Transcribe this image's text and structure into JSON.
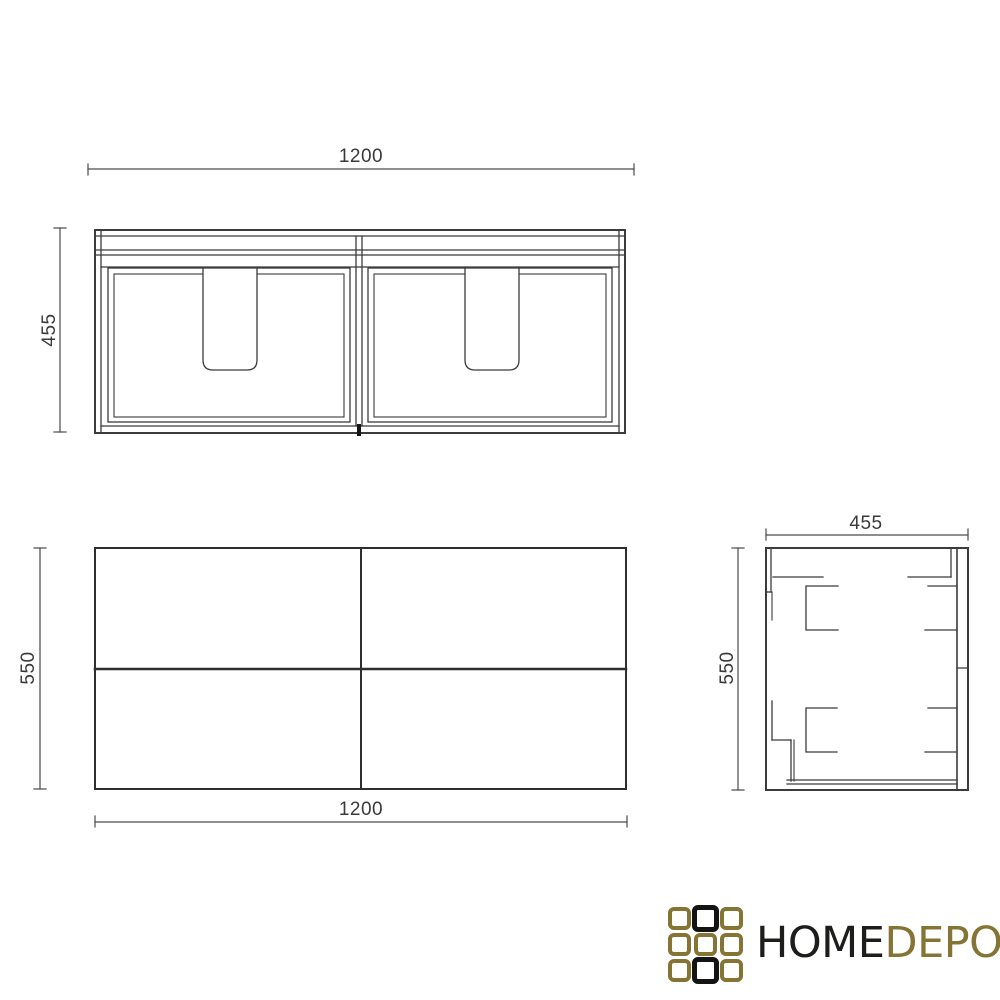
{
  "page": {
    "background_color": "#ffffff",
    "description": "cabinet technical drawing with three orthographic views"
  },
  "dimensions": {
    "front_width": "1200",
    "front_height": "455",
    "plan_depth": "550",
    "plan_width": "1200",
    "side_depth": "455",
    "side_height": "550"
  },
  "drawing": {
    "line_color": "#3b3b3b",
    "dim_line_color": "#4a4a4a",
    "dim_text_color": "#3a3a3a"
  },
  "logo": {
    "text_primary": "HOME",
    "text_secondary": "DEPO",
    "primary_color": "#1d1d1b",
    "gold_color": "#857434",
    "grid_pattern": [
      [
        "gold",
        "black",
        "gold"
      ],
      [
        "gold",
        "gold",
        "gold"
      ],
      [
        "gold",
        "black",
        "gold"
      ]
    ]
  }
}
